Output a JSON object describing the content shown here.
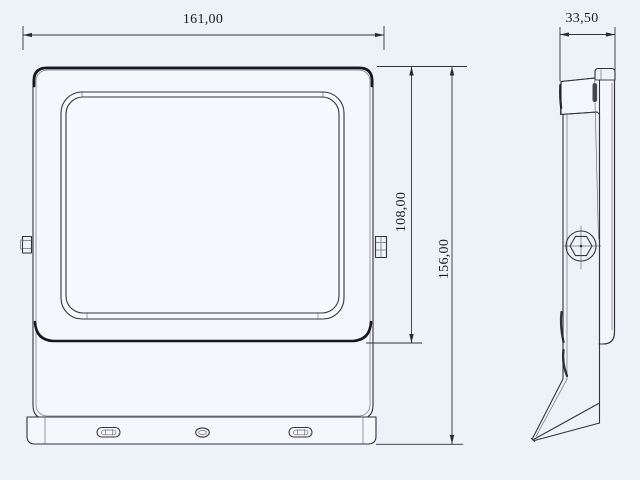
{
  "drawing": {
    "type": "technical-orthographic-drawing",
    "subject": "LED floodlight, front and side views"
  },
  "dimensions": {
    "width_label": "161,00",
    "depth_label": "33,50",
    "head_height_label": "108,00",
    "overall_height_label": "156,00"
  },
  "colors": {
    "background": "#edf1f8",
    "line": "#34343c",
    "line_dark": "#17171d",
    "text": "#1b1b22"
  }
}
